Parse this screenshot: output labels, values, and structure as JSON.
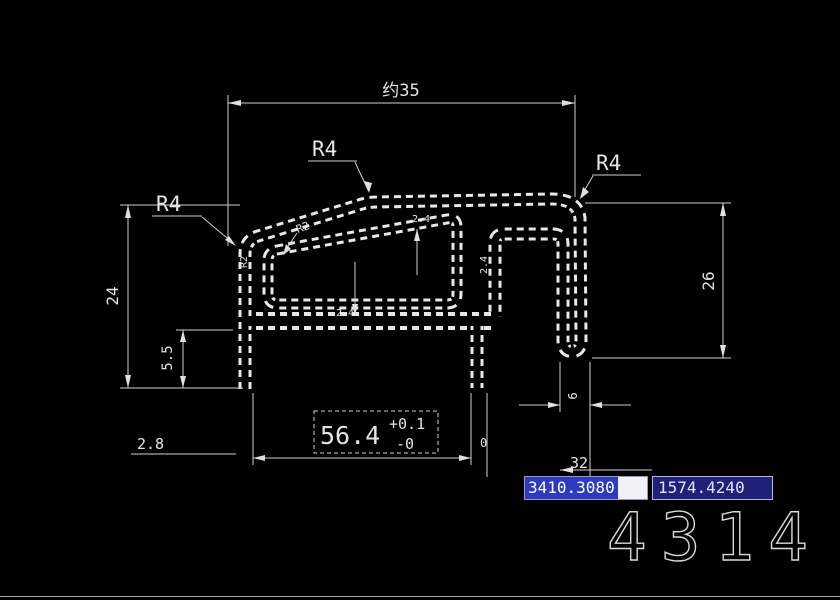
{
  "drawing": {
    "dim_top_width": "约35",
    "dim_left_height": "24",
    "dim_right_height": "26",
    "dim_left_foot_height": "5.5",
    "dim_bottom_left": "2.8",
    "dim_bottom_width_value": "56.4",
    "dim_bottom_width_tol_upper": "+0.1",
    "dim_bottom_width_tol_lower": "-0",
    "dim_zero_marker": "0",
    "dim_right_foot_width": "6",
    "dim_right_offset": "32",
    "radius_label_top": "R4",
    "radius_label_right": "R4",
    "radius_label_left": "R4",
    "fillet_label_slant": "R2",
    "fillet_label_leg": "R2",
    "thickness_top_wall": "2.4",
    "thickness_bottom_wall": "2.4",
    "thickness_right_wall": "2.4"
  },
  "status_bar": {
    "coord_x": "3410.3080",
    "coord_y": "1574.4240"
  },
  "part_number": "4314",
  "colors": {
    "background": "#000000",
    "line": "#e0e0e0",
    "selection_blue": "#2e3bc0",
    "field_navy": "#1f2078",
    "field_light": "#f2f1fa"
  }
}
